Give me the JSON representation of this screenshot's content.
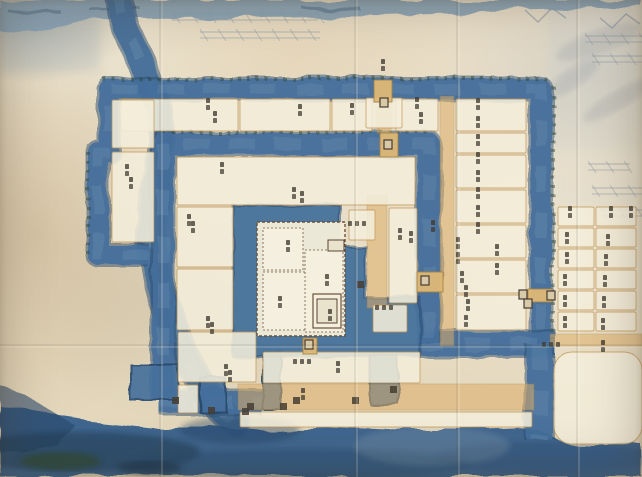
{
  "canvas": {
    "w": 642,
    "h": 477
  },
  "palette": {
    "paper": "#e8deca",
    "water": "#46709c",
    "water_dark": "#27496d",
    "water_light": "#6b8fb3",
    "river": "#47709a",
    "bottom_water": "#38608c",
    "top_strip": "#85a0b4",
    "road_fill": "#dcae68",
    "road_line": "#a8813f",
    "parcel_fill": "#f3edda",
    "parcel_line": "#c09453",
    "wall_ink": "#6a5138",
    "label_ink": "#3f3930",
    "vegetation": "#2e4531",
    "sketch": "#7d8da0",
    "smudge": "#8a9099",
    "gate_dark": "#453d32",
    "gate_fill": "#d8c9a8",
    "bridge_fill": "#dfb977"
  },
  "map": {
    "moat_strokes": [
      {
        "name": "outer-moat-ring",
        "pts": [
          [
            148,
            255
          ],
          [
            98,
            255
          ],
          [
            98,
            152
          ],
          [
            109,
            152
          ],
          [
            109,
            89
          ],
          [
            541,
            89
          ],
          [
            541,
            344
          ]
        ],
        "w": 20
      },
      {
        "name": "outer-moat-east-channel",
        "pts": [
          [
            418,
            344
          ],
          [
            556,
            344
          ]
        ],
        "w": 24
      },
      {
        "name": "outer-moat-south-channel",
        "pts": [
          [
            540,
            344
          ],
          [
            540,
            440
          ]
        ],
        "w": 26
      },
      {
        "name": "second-ring-moat",
        "pts": [
          [
            163,
            400
          ],
          [
            163,
            144
          ],
          [
            429,
            144
          ],
          [
            429,
            344
          ]
        ],
        "w": 22
      },
      {
        "name": "second-ring-south-moat",
        "pts": [
          [
            160,
            402
          ],
          [
            262,
            402
          ]
        ],
        "w": 22
      }
    ],
    "water_rects": [
      {
        "name": "sw-bastion-pond",
        "r": [
          130,
          364,
          48,
          36
        ]
      },
      {
        "name": "sw-channel",
        "r": [
          200,
          378,
          26,
          34
        ]
      },
      {
        "name": "ninomaru-west-channel",
        "r": [
          263,
          352,
          18,
          58
        ]
      },
      {
        "name": "ninomaru-east-pond",
        "r": [
          370,
          356,
          28,
          48
        ]
      }
    ],
    "honmaru_moat_pts": [
      [
        233,
        205
      ],
      [
        340,
        205
      ],
      [
        340,
        246
      ],
      [
        365,
        246
      ],
      [
        365,
        298
      ],
      [
        420,
        298
      ],
      [
        420,
        356
      ],
      [
        233,
        356
      ]
    ],
    "river_pts": [
      [
        118,
        -6
      ],
      [
        127,
        30
      ],
      [
        143,
        64
      ],
      [
        156,
        100
      ],
      [
        163,
        140
      ],
      [
        158,
        180
      ],
      [
        152,
        215
      ],
      [
        152,
        248
      ],
      [
        158,
        282
      ],
      [
        166,
        312
      ],
      [
        177,
        340
      ],
      [
        190,
        365
      ],
      [
        205,
        390
      ],
      [
        220,
        410
      ],
      [
        236,
        424
      ]
    ],
    "river_width": 24,
    "bottom_water_pts": [
      [
        0,
        406
      ],
      [
        40,
        412
      ],
      [
        90,
        420
      ],
      [
        150,
        426
      ],
      [
        210,
        426
      ],
      [
        260,
        430
      ],
      [
        330,
        427
      ],
      [
        400,
        430
      ],
      [
        470,
        430
      ],
      [
        530,
        428
      ],
      [
        552,
        436
      ],
      [
        580,
        445
      ],
      [
        642,
        445
      ],
      [
        642,
        477
      ],
      [
        0,
        477
      ]
    ],
    "left_bank_pts": [
      [
        0,
        386
      ],
      [
        26,
        396
      ],
      [
        50,
        410
      ],
      [
        76,
        426
      ],
      [
        58,
        446
      ],
      [
        0,
        452
      ]
    ],
    "top_strip_pts": [
      [
        0,
        0
      ],
      [
        642,
        0
      ],
      [
        642,
        7
      ],
      [
        520,
        10
      ],
      [
        380,
        14
      ],
      [
        260,
        16
      ],
      [
        150,
        18
      ],
      [
        80,
        22
      ],
      [
        40,
        27
      ],
      [
        0,
        31
      ]
    ],
    "water_blobs": [
      [
        80,
        452,
        120,
        20,
        "#1d3850",
        0.5
      ],
      [
        300,
        464,
        170,
        15,
        "#24466b",
        0.38
      ],
      [
        545,
        458,
        110,
        16,
        "#2a4c72",
        0.35
      ],
      [
        60,
        461,
        40,
        9,
        "#2e4a38",
        0.8
      ],
      [
        150,
        468,
        32,
        7,
        "#1e3448",
        0.6
      ],
      [
        432,
        446,
        78,
        20,
        "#c2ccc8",
        0.16
      ],
      [
        240,
        430,
        60,
        14,
        "#22405e",
        0.4
      ]
    ],
    "washes": [
      [
        548,
        0,
        94,
        150,
        "#b9c8d2",
        0.2
      ],
      [
        0,
        0,
        100,
        72,
        "#93a6b4",
        0.22
      ],
      [
        556,
        150,
        86,
        60,
        "#c5d0d8",
        0.1
      ]
    ],
    "vegetation_lines": [
      [
        103,
        79,
        552,
        79
      ],
      [
        163,
        132,
        429,
        132
      ],
      [
        553,
        86,
        553,
        340
      ],
      [
        88,
        152,
        88,
        255
      ]
    ],
    "roads": [
      [
        440,
        96,
        14,
        250
      ],
      [
        238,
        384,
        296,
        26
      ],
      [
        550,
        334,
        92,
        12
      ],
      [
        377,
        98,
        14,
        35
      ],
      [
        367,
        195,
        20,
        113
      ]
    ],
    "parcels": [
      [
        121,
        99,
        117,
        32
      ],
      [
        240,
        99,
        90,
        32
      ],
      [
        332,
        99,
        40,
        32
      ],
      [
        396,
        99,
        42,
        32
      ],
      [
        456,
        99,
        70,
        32
      ],
      [
        456,
        133,
        70,
        20
      ],
      [
        456,
        155,
        70,
        33
      ],
      [
        456,
        190,
        70,
        33
      ],
      [
        456,
        225,
        70,
        33
      ],
      [
        456,
        260,
        70,
        33
      ],
      [
        456,
        295,
        70,
        35
      ],
      [
        112,
        100,
        42,
        48
      ],
      [
        112,
        152,
        42,
        90
      ],
      [
        177,
        157,
        238,
        48
      ],
      [
        177,
        207,
        56,
        60
      ],
      [
        177,
        269,
        56,
        61
      ],
      [
        178,
        332,
        78,
        50
      ],
      [
        178,
        385,
        20,
        28
      ],
      [
        349,
        210,
        26,
        30
      ],
      [
        389,
        208,
        28,
        95
      ],
      [
        373,
        305,
        34,
        27
      ],
      [
        263,
        352,
        157,
        31
      ],
      [
        240,
        412,
        292,
        15
      ],
      [
        366,
        98,
        36,
        30
      ],
      [
        554,
        352,
        88,
        92,
        18
      ]
    ],
    "east_grid": {
      "cols": [
        [
          558,
          36
        ],
        [
          596,
          40
        ]
      ],
      "y0": 207,
      "rows": 6,
      "rh": 21,
      "ph": 19
    },
    "compound": {
      "wall": [
        257,
        222,
        88,
        114
      ],
      "yards": [
        [
          263,
          228,
          40,
          42
        ],
        [
          263,
          272,
          44,
          58
        ],
        [
          305,
          250,
          38,
          82
        ]
      ],
      "keep": [
        313,
        294,
        28,
        34
      ],
      "blocks": [
        [
          317,
          299,
          20,
          24
        ],
        [
          328,
          240,
          16,
          11
        ]
      ]
    },
    "bridges": [
      [
        374,
        80,
        18,
        22
      ],
      [
        380,
        133,
        18,
        24
      ],
      [
        528,
        289,
        24,
        13
      ],
      [
        417,
        272,
        26,
        20
      ],
      [
        303,
        338,
        14,
        16
      ]
    ],
    "gates_t1": [
      [
        380,
        98
      ],
      [
        384,
        140
      ],
      [
        519,
        290
      ],
      [
        524,
        299
      ],
      [
        547,
        291
      ],
      [
        421,
        276
      ],
      [
        305,
        340
      ]
    ],
    "gates_t2": [
      [
        357,
        281
      ],
      [
        247,
        403
      ],
      [
        280,
        403
      ],
      [
        293,
        397
      ],
      [
        352,
        397
      ],
      [
        390,
        386
      ],
      [
        172,
        397
      ],
      [
        208,
        407
      ],
      [
        242,
        408
      ]
    ],
    "labels_v": [
      [
        208,
        104
      ],
      [
        215,
        117
      ],
      [
        300,
        110
      ],
      [
        352,
        109
      ],
      [
        417,
        103
      ],
      [
        421,
        118
      ],
      [
        478,
        104
      ],
      [
        478,
        122
      ],
      [
        478,
        140
      ],
      [
        478,
        158
      ],
      [
        478,
        176
      ],
      [
        478,
        193
      ],
      [
        478,
        211
      ],
      [
        478,
        228
      ],
      [
        433,
        226
      ],
      [
        458,
        243
      ],
      [
        458,
        258
      ],
      [
        462,
        277
      ],
      [
        466,
        291
      ],
      [
        468,
        305
      ],
      [
        466,
        321
      ],
      [
        497,
        250
      ],
      [
        497,
        269
      ],
      [
        570,
        212
      ],
      [
        611,
        212
      ],
      [
        631,
        212
      ],
      [
        567,
        238
      ],
      [
        608,
        240
      ],
      [
        567,
        258
      ],
      [
        606,
        260
      ],
      [
        565,
        280
      ],
      [
        605,
        281
      ],
      [
        565,
        301
      ],
      [
        604,
        302
      ],
      [
        565,
        322
      ],
      [
        603,
        324
      ],
      [
        603,
        346
      ],
      [
        127,
        170
      ],
      [
        131,
        183
      ],
      [
        222,
        168
      ],
      [
        294,
        193
      ],
      [
        302,
        197
      ],
      [
        189,
        220
      ],
      [
        193,
        227
      ],
      [
        208,
        322
      ],
      [
        212,
        328
      ],
      [
        226,
        370
      ],
      [
        230,
        376
      ],
      [
        400,
        234
      ],
      [
        411,
        237
      ],
      [
        288,
        246
      ],
      [
        280,
        302
      ],
      [
        327,
        280
      ],
      [
        330,
        315
      ],
      [
        338,
        367
      ],
      [
        303,
        394
      ],
      [
        383,
        65
      ]
    ],
    "labels_h": [
      [
        358,
        224
      ],
      [
        385,
        308
      ],
      [
        303,
        362
      ],
      [
        552,
        345
      ]
    ],
    "sketch_rows": [
      [
        172,
        14,
        318,
        14
      ],
      [
        200,
        32,
        320,
        32
      ],
      [
        585,
        36,
        642,
        36
      ],
      [
        592,
        56,
        642,
        56
      ],
      [
        588,
        164,
        630,
        164
      ],
      [
        592,
        188,
        642,
        188
      ],
      [
        600,
        210,
        642,
        210
      ]
    ],
    "squiggles": [
      [
        [
          525,
          10
        ],
        [
          538,
          22
        ],
        [
          552,
          8
        ],
        [
          566,
          18
        ]
      ],
      [
        [
          600,
          18
        ],
        [
          612,
          28
        ],
        [
          626,
          14
        ],
        [
          640,
          24
        ]
      ]
    ],
    "smudges": [
      [
        598,
        42,
        44,
        12,
        -20
      ],
      [
        573,
        78,
        30,
        10,
        -35
      ],
      [
        618,
        100,
        40,
        9,
        -30
      ]
    ],
    "strip_marks": [
      [
        5,
        8,
        60,
        11
      ],
      [
        90,
        10,
        140,
        8
      ],
      [
        300,
        6,
        360,
        8
      ]
    ],
    "creases_v": [
      160,
      355,
      457,
      577
    ],
    "creases_h": [
      345
    ]
  }
}
